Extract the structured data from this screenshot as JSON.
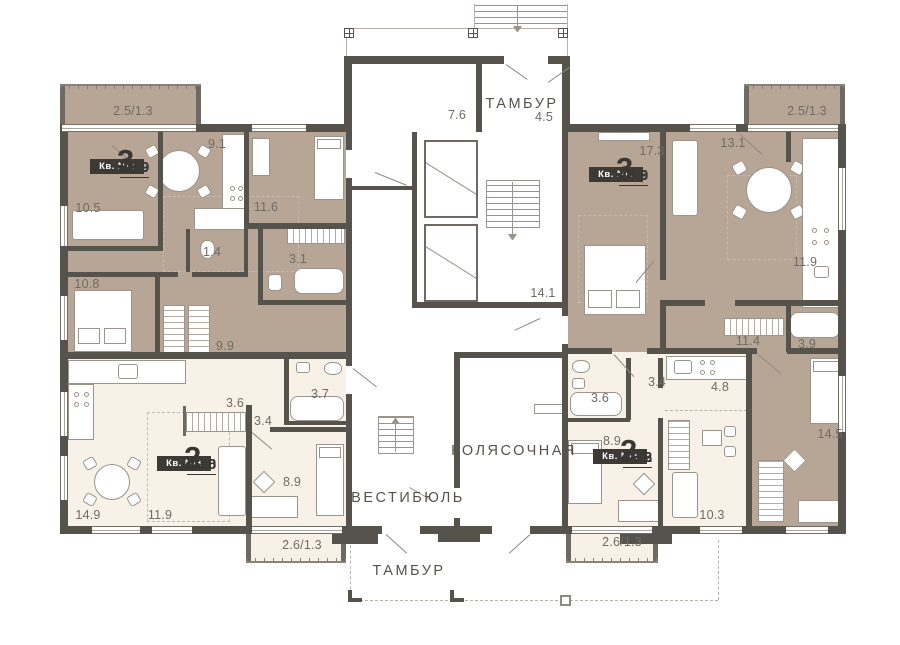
{
  "plan_type": "residential floor plan",
  "common_labels": [
    {
      "text": "ТАМБУР",
      "x": 522,
      "y": 104
    },
    {
      "text": "ТАМБУР",
      "x": 409,
      "y": 571
    },
    {
      "text": "ВЕСТИБЮЛЬ",
      "x": 408,
      "y": 498
    },
    {
      "text": "КОЛЯСОЧНАЯ",
      "x": 514,
      "y": 451
    }
  ],
  "room_area_labels": [
    {
      "text": "2.5/1.3",
      "x": 133,
      "y": 111
    },
    {
      "text": "9.1",
      "x": 217,
      "y": 144
    },
    {
      "text": "10.5",
      "x": 88,
      "y": 208
    },
    {
      "text": "11.6",
      "x": 266,
      "y": 207
    },
    {
      "text": "1.4",
      "x": 212,
      "y": 252
    },
    {
      "text": "3.1",
      "x": 298,
      "y": 259
    },
    {
      "text": "10.8",
      "x": 87,
      "y": 284
    },
    {
      "text": "9.9",
      "x": 225,
      "y": 346
    },
    {
      "text": "7.6",
      "x": 457,
      "y": 115
    },
    {
      "text": "4.5",
      "x": 544,
      "y": 117
    },
    {
      "text": "14.1",
      "x": 543,
      "y": 293
    },
    {
      "text": "17.3",
      "x": 652,
      "y": 151
    },
    {
      "text": "13.1",
      "x": 733,
      "y": 143
    },
    {
      "text": "2.5/1.3",
      "x": 807,
      "y": 111
    },
    {
      "text": "11.9",
      "x": 805,
      "y": 262
    },
    {
      "text": "11.4",
      "x": 748,
      "y": 341
    },
    {
      "text": "3.9",
      "x": 807,
      "y": 344
    },
    {
      "text": "14.5",
      "x": 830,
      "y": 434
    },
    {
      "text": "3.6",
      "x": 235,
      "y": 403
    },
    {
      "text": "3.4",
      "x": 263,
      "y": 421
    },
    {
      "text": "3.7",
      "x": 320,
      "y": 394
    },
    {
      "text": "8.9",
      "x": 292,
      "y": 482
    },
    {
      "text": "14.9",
      "x": 88,
      "y": 515
    },
    {
      "text": "11.9",
      "x": 160,
      "y": 515
    },
    {
      "text": "2.6/1.3",
      "x": 302,
      "y": 545
    },
    {
      "text": "3.4",
      "x": 657,
      "y": 382
    },
    {
      "text": "4.8",
      "x": 720,
      "y": 387
    },
    {
      "text": "3.6",
      "x": 600,
      "y": 398
    },
    {
      "text": "8.9",
      "x": 612,
      "y": 441
    },
    {
      "text": "10.3",
      "x": 712,
      "y": 515
    },
    {
      "text": "2.6/1.3",
      "x": 622,
      "y": 542
    }
  ],
  "apartment_cards": [
    {
      "badge": "Кв. №4",
      "rooms": "3",
      "living_area": "32.9",
      "total_area": "58.9",
      "x": 117,
      "y": 159
    },
    {
      "badge": "Кв. №1",
      "rooms": "3",
      "living_area": "44.9",
      "total_area": "74.6",
      "x": 616,
      "y": 167
    },
    {
      "badge": "Кв. №3",
      "rooms": "2",
      "living_area": "20.8",
      "total_area": "49.0",
      "x": 184,
      "y": 456
    },
    {
      "badge": "Кв. №2",
      "rooms": "2",
      "living_area": "19.2",
      "total_area": "33.6",
      "x": 620,
      "y": 449
    }
  ],
  "colors": {
    "wall": "#56524c",
    "apartment_brown": "#b7a695",
    "apartment_cream": "#f8f1e8",
    "common_white": "#ffffff",
    "label_gray": "#6f6b65",
    "badge_bg": "#3d3a36",
    "badge_text": "#ffffff"
  }
}
